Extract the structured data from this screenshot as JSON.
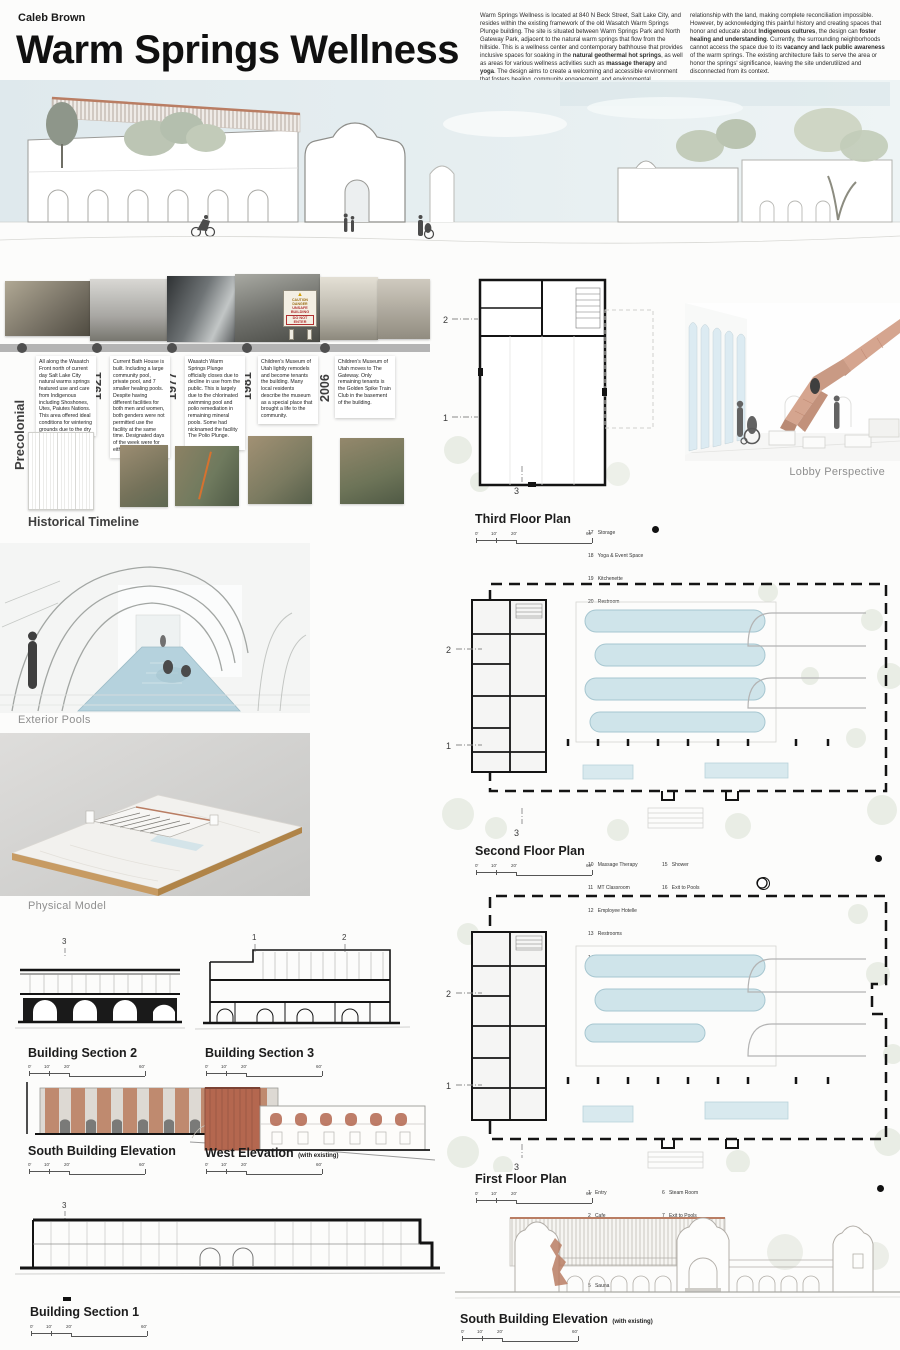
{
  "header": {
    "author": "Caleb Brown",
    "title": "Warm Springs Wellness"
  },
  "intro": {
    "p1a": "Warm Springs Wellness is located at 840 N Beck Street, Salt Lake City, and resides within the existing framework of the old Wasatch Warm Springs Plunge building. The site is situated between Warm Springs Park and North Gateway Park, adjacent to the natural warm springs that flow from the hillside. This is a wellness center and contemporary bathhouse that provides inclusive spaces for soaking in the **natural geothermal hot springs**, as well as areas for various wellness activities such as **massage therapy** and **yoga**. The design aims to create a welcoming and accessible environment that fosters healing, community engagement, and environmental stewardship.",
    "p1b": "The project concept explores the relationships between the **environment**, the **community**, and the **built environment**. The geothermal activity provides natural hot springs, which the current architecture does not utilize. The site's history of colonization disrupted Indigenous peoples'",
    "p2a": "relationship with the land, making complete reconciliation impossible. However, by acknowledging this painful history and creating spaces that honor and educate about **Indigenous cultures**, the design can **foster healing and understanding**. Currently, the surrounding neighborhoods cannot access the space due to its **vacancy and lack public awareness** of the warm springs. The existing architecture fails to serve the area or honor the springs' significance, leaving the site underutilized and disconnected from its context.",
    "p2b": "Warm Springs Wellness creates an **inclusive** and **accessible** space that honors the site's rich cultural heritage, promotes **environmental stewardship**, and provides a sanctuary for healing and community engagement. The design thoughtfully considers the site's **historical significance**, **sustainable practices**, and the needs of the **surrounding community**."
  },
  "timeline": {
    "heading": "Historical Timeline",
    "entries": [
      {
        "year": "Precolonial",
        "text": "All along the Wasatch Front north of current day Salt Lake City natural warms springs featured use and care from Indigenous including Shoshones, Utes, Paiutes Nations. This area offered ideal conditions for wintering grounds due to the dry warm ground and warm bathing."
      },
      {
        "year": "1921",
        "text": "Current Bath House is built. Including a large community pool, private pool, and 7 smaller healing pools. Despite having different facilities for both men and women, both genders were not permitted use the facility at the same time. Designated days of the week were for either men or women."
      },
      {
        "year": "1977",
        "text": "Wasatch Warm Springs Plunge officially closes due to decline in use from the public. This is largely due to the chlorinated swimming pool and polio remediation in remaining mineral pools. Some had nicknamed the facility The Polio Plunge."
      },
      {
        "year": "1981",
        "text": "Children's Museum of Utah lightly remodels and become tenants the building. Many local residents describe the museum as a special place that brought a life to the community."
      },
      {
        "year": "2006",
        "text": "Children's Museum of Utah moves to The Gateway. Only remaining tenants is the Golden Spike Train Club in the basement of the building."
      }
    ]
  },
  "sign": {
    "l1": "CAUTION DANGER",
    "l2": "UNSAFE BUILDING",
    "l3": "DO NOT ENTER"
  },
  "views": {
    "lobby": "Lobby Perspective",
    "pools": "Exterior Pools",
    "model": "Physical Model"
  },
  "plans": {
    "third": {
      "label": "Third Floor Plan",
      "legend": [
        "17   Storage",
        "18   Yoga & Event Space",
        "19   Kitchenette",
        "20   Restroom"
      ]
    },
    "second": {
      "label": "Second Floor Plan",
      "legend_a": [
        "10   Massage Therapy",
        "11   MT Classroom",
        "12   Employee Hotelle",
        "13   Restrooms",
        "14   Sauna"
      ],
      "legend_b": [
        "15   Shower",
        "16   Exit to Pools"
      ]
    },
    "first": {
      "label": "First Floor Plan",
      "legend_a": [
        "1   Entry",
        "2   Cafe",
        "3   Reception",
        "4   Restroom & Changing",
        "5   Sauna"
      ],
      "legend_b": [
        "6   Steam Room",
        "7   Exit to Pools",
        "8   Private Plunge Pools",
        "9   Mechanical"
      ]
    }
  },
  "sections": {
    "s1": "Building Section 1",
    "s2": "Building Section 2",
    "s3": "Building Section 3"
  },
  "elevations": {
    "south": "South Building Elevation",
    "west": "West Elevation",
    "west_suffix": "(with existing)",
    "south_existing": "South Building Elevation",
    "south_existing_suffix": "(with existing)"
  },
  "scale": [
    "0'",
    "10'",
    "20'",
    "60'"
  ],
  "marks": {
    "n1": "1",
    "n2": "2",
    "n3": "3"
  },
  "colors": {
    "terracotta": "#c28a72",
    "pool_blue": "#cfe4ea",
    "timeline_gray": "#b4b4b4"
  }
}
